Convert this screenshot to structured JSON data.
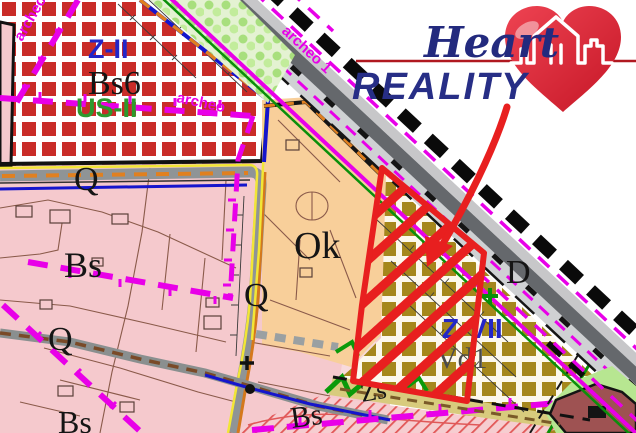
{
  "logo": {
    "title_script": "Heart",
    "title_caps": "REALITY",
    "heart_icon": "heart-with-house-icon"
  },
  "zone_labels": {
    "z2": "Z-II",
    "bs6": "Bs6",
    "us2": "US-II",
    "q": "Q",
    "bs": "Bs",
    "ok": "Ok",
    "d": "D",
    "z7": "Z-VII",
    "vd1": "Vd1",
    "zs": "Zs"
  },
  "annotations": {
    "archeo": "archeo",
    "archeo_road": "archeo 1"
  },
  "colors": {
    "checker_red": "#c92c28",
    "pink_zone": "#f5c9cd",
    "orange_zone": "#f8cf9a",
    "olive_checker": "#a5871c",
    "khaki_strip": "#d8cb7d",
    "light_green": "#b7e691",
    "maroon_building": "#9e5252",
    "magenta_line": "#e800e8",
    "blue_line": "#1515cc",
    "green_line": "#0a8f0a",
    "orange_line": "#e08020",
    "yellow_line": "#f2e636",
    "selection_red": "#e81f1f",
    "logo_navy": "#272e86",
    "logo_red": "#b01820",
    "heart_red": "#e0313f"
  }
}
